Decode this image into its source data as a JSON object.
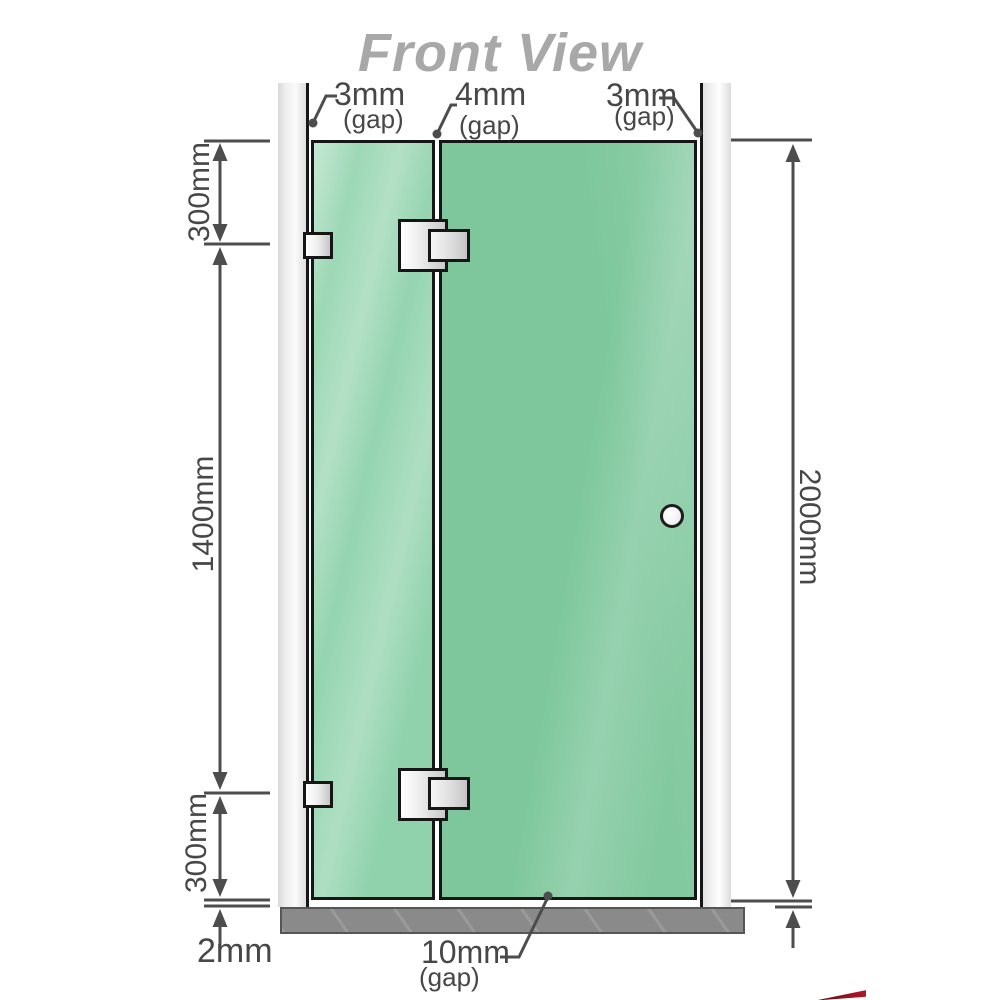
{
  "title": "Front View",
  "annotations": {
    "gap_top_left": {
      "value": "3mm",
      "note": "(gap)"
    },
    "gap_top_middle": {
      "value": "4mm",
      "note": "(gap)"
    },
    "gap_top_right": {
      "value": "3mm",
      "note": "(gap)"
    },
    "gap_bottom": {
      "value": "10mm",
      "note": "(gap)"
    },
    "floor_gap": "2mm"
  },
  "dimensions": {
    "segment_top_left": "300mm",
    "segment_middle_left": "1400mm",
    "segment_bottom_left": "300mm",
    "overall_right": "2000mm"
  },
  "colors": {
    "line": "#4d4d4d",
    "title": "#a8a8a8",
    "glass": "#7ec79c",
    "glass-light": "#8fd2ab",
    "wall": "#ececec",
    "floor": "#8a8a8a",
    "hardware": "#e8e8e8",
    "border": "#161616"
  }
}
